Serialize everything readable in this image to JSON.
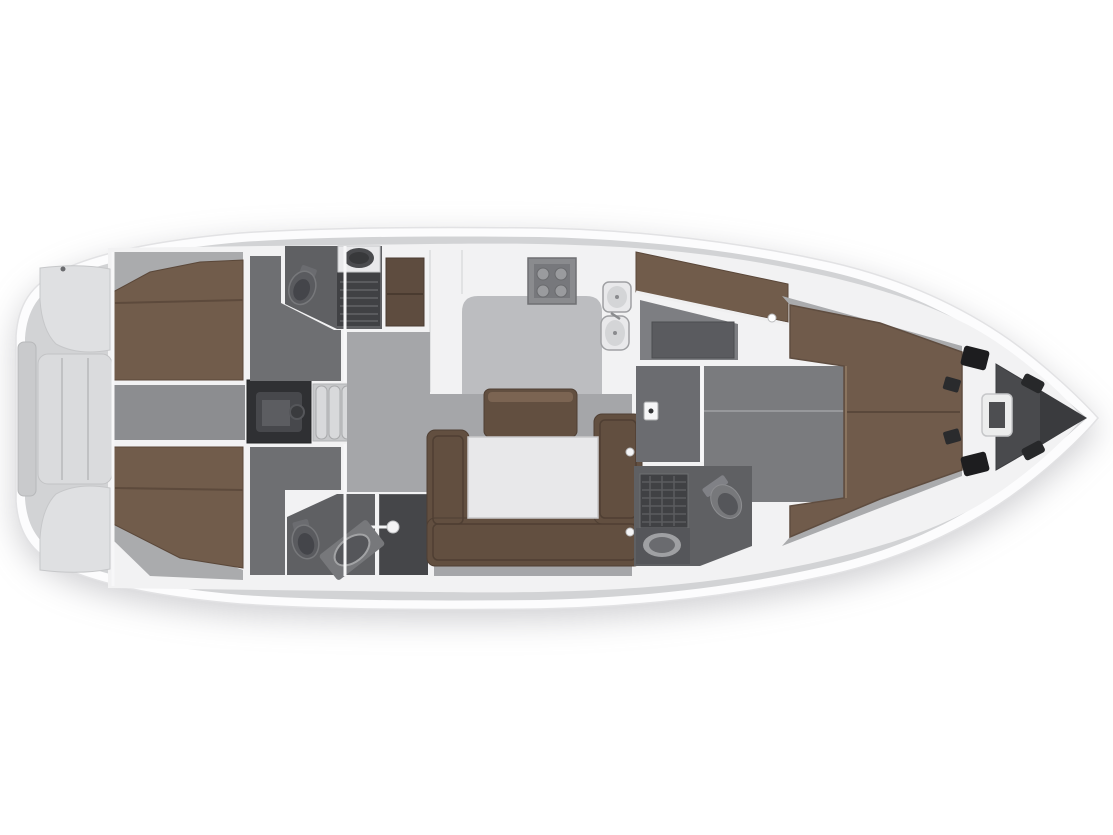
{
  "figure": {
    "kind": "sailing-yacht-interior-floor-plan",
    "orientation": "bow-right"
  },
  "palette": {
    "page_bg": "#ffffff",
    "hull_white": "#fcfcfd",
    "hull_edge": "#e2e2e4",
    "deck_grey": "#d2d3d5",
    "interior_white": "#f2f2f3",
    "cockpit_bench": "#dfe0e2",
    "helm_seat": "#dadbdd",
    "transom_step": "#c9cacc",
    "instrument_pod": "#c3c4c6",
    "corridor_floor": "#8c8d90",
    "engine_dark": "#2f3033",
    "engine_block": "#47484c",
    "steps_grey": "#c7c8ca",
    "step_tread": "#d8d9db",
    "bed_brown": "#715c4b",
    "bed_seam": "#5d4a3c",
    "cabin_floor": "#6e6f72",
    "wedge_grey": "#aaabad",
    "head_floor": "#5f6063",
    "shower_dark": "#404144",
    "shower_stall": "#454649",
    "fixture_dark": "#55565a",
    "fixture_mid": "#77787b",
    "toilet_grey": "#5a5b5f",
    "porcelain": "#e9e9eb",
    "locker_brown": "#5e4c3f",
    "galley_floor": "#bcbdc0",
    "salon_floor": "#a5a6a9",
    "settee_brown": "#624f40",
    "settee_light": "#7b6452",
    "table_white": "#e8e8ea",
    "midcabin_floor": "#7d7e82",
    "midcabin_box": "#5a5b5f",
    "fwd_corridor": "#6b6c70",
    "fwd_floor": "#7a7b7e",
    "vberth_brown": "#705b4b",
    "black_locker": "#1d1d1f",
    "anchor_floor": "#494a4d",
    "anchor_dark": "#3a3b3e",
    "windlass_white": "#eceded",
    "stove_grey": "#8a8b8e",
    "stove_panel": "#77787c",
    "burner_grey": "#9a9b9e",
    "latch_white": "#f6f6f7"
  },
  "regions": {
    "stern": [
      "swim-platform",
      "cockpit",
      "cockpit-bench-port",
      "cockpit-bench-starboard",
      "helm-seat"
    ],
    "aft": [
      "aft-cabin-port",
      "aft-cabin-starboard",
      "aft-head-port",
      "aft-head-starboard",
      "engine-compartment",
      "companionway-steps"
    ],
    "midship": [
      "galley",
      "salon",
      "salon-table",
      "salon-settee",
      "nav-bench"
    ],
    "forward": [
      "mid-bunk-cabin",
      "forward-head",
      "vberth-master-cabin",
      "anchor-locker",
      "windlass"
    ]
  }
}
